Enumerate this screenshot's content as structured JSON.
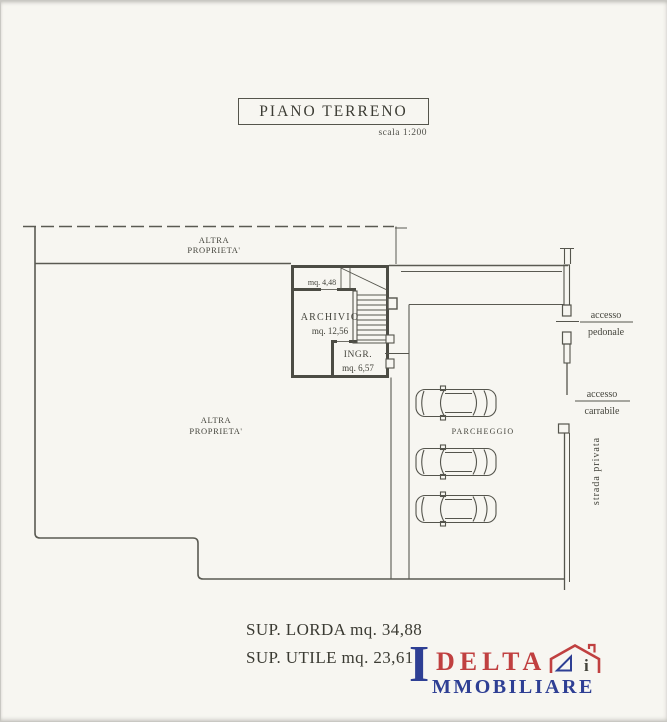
{
  "header": {
    "title": "PIANO TERRENO",
    "scale_note": "scala 1:200"
  },
  "plan": {
    "top_strip": {
      "line1": "ALTRA",
      "line2": "PROPRIETA'"
    },
    "main_area": {
      "line1": "ALTRA",
      "line2": "PROPRIETA'"
    },
    "rooms": {
      "vano_scala_area": "mq. 4,48",
      "archivio_name": "ARCHIVIO",
      "archivio_area": "mq. 12,56",
      "ingresso_name": "INGR.",
      "ingresso_area": "mq. 6,57"
    },
    "parking_label": "PARCHEGGIO",
    "access": {
      "pedonale_line1": "accesso",
      "pedonale_line2": "pedonale",
      "carrabile_line1": "accesso",
      "carrabile_line2": "carrabile"
    },
    "street_label": "strada privata"
  },
  "summary": {
    "sup_lorda": "SUP. LORDA mq. 34,88",
    "sup_utile": "SUP. UTILE mq. 23,61"
  },
  "logo": {
    "initial": "I",
    "delta": "DELTA",
    "immobiliare": "MMOBILIARE",
    "house_letter": "i",
    "red": "#c04040",
    "blue": "#2e3f94"
  }
}
